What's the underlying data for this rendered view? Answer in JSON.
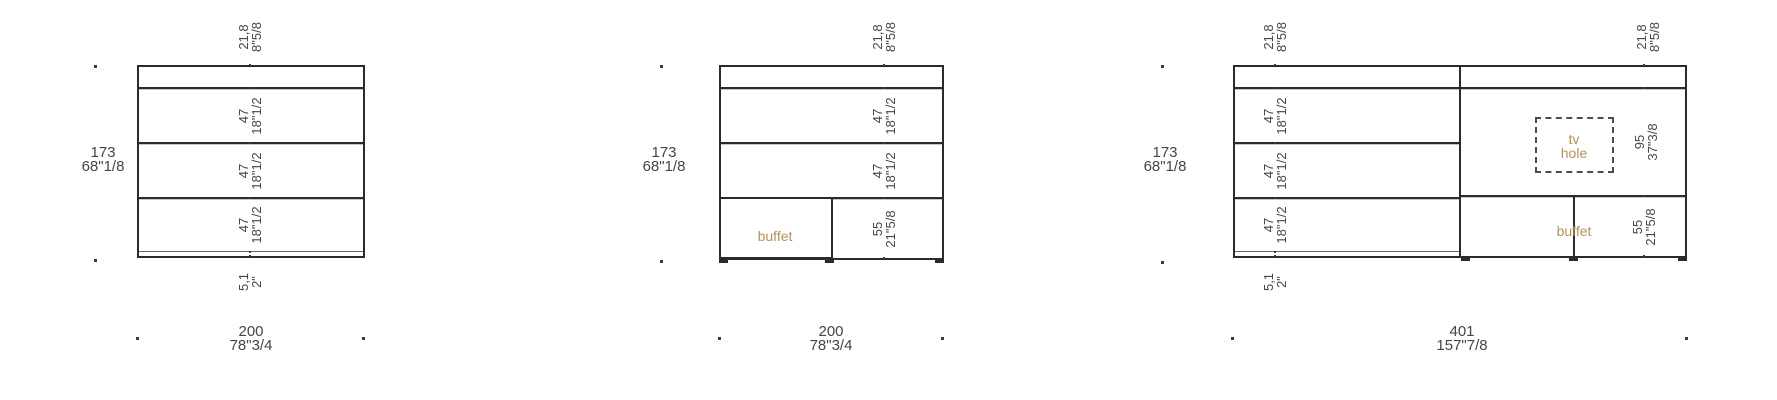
{
  "colors": {
    "line": "#2b2b2b",
    "dimension_text": "#454545",
    "accent_tan": "#b3925c"
  },
  "diagram1": {
    "top_cm": "21,8",
    "top_in": "8\"5/8",
    "row1_cm": "47",
    "row1_in": "18\"1/2",
    "row2_cm": "47",
    "row2_in": "18\"1/2",
    "row3_cm": "47",
    "row3_in": "18\"1/2",
    "plinth_cm": "5,1",
    "plinth_in": "2\"",
    "height_cm": "173",
    "height_in": "68\"1/8",
    "width_cm": "200",
    "width_in": "78\"3/4"
  },
  "diagram2": {
    "top_cm": "21,8",
    "top_in": "8\"5/8",
    "row1_cm": "47",
    "row1_in": "18\"1/2",
    "row2_cm": "47",
    "row2_in": "18\"1/2",
    "buffet_cm": "55",
    "buffet_in": "21\"5/8",
    "buffet_label": "buffet",
    "height_cm": "173",
    "height_in": "68\"1/8",
    "width_cm": "200",
    "width_in": "78\"3/4"
  },
  "diagram3": {
    "left_top_cm": "21,8",
    "left_top_in": "8\"5/8",
    "row1_cm": "47",
    "row1_in": "18\"1/2",
    "row2_cm": "47",
    "row2_in": "18\"1/2",
    "row3_cm": "47",
    "row3_in": "18\"1/2",
    "plinth_cm": "5,1",
    "plinth_in": "2\"",
    "right_top_cm": "21,8",
    "right_top_in": "8\"5/8",
    "tv_cm": "95",
    "tv_in": "37\"3/8",
    "tv_line1": "tv",
    "tv_line2": "hole",
    "buffet_cm": "55",
    "buffet_in": "21\"5/8",
    "buffet_label": "buffet",
    "height_cm": "173",
    "height_in": "68\"1/8",
    "width_cm": "401",
    "width_in": "157\"7/8"
  }
}
